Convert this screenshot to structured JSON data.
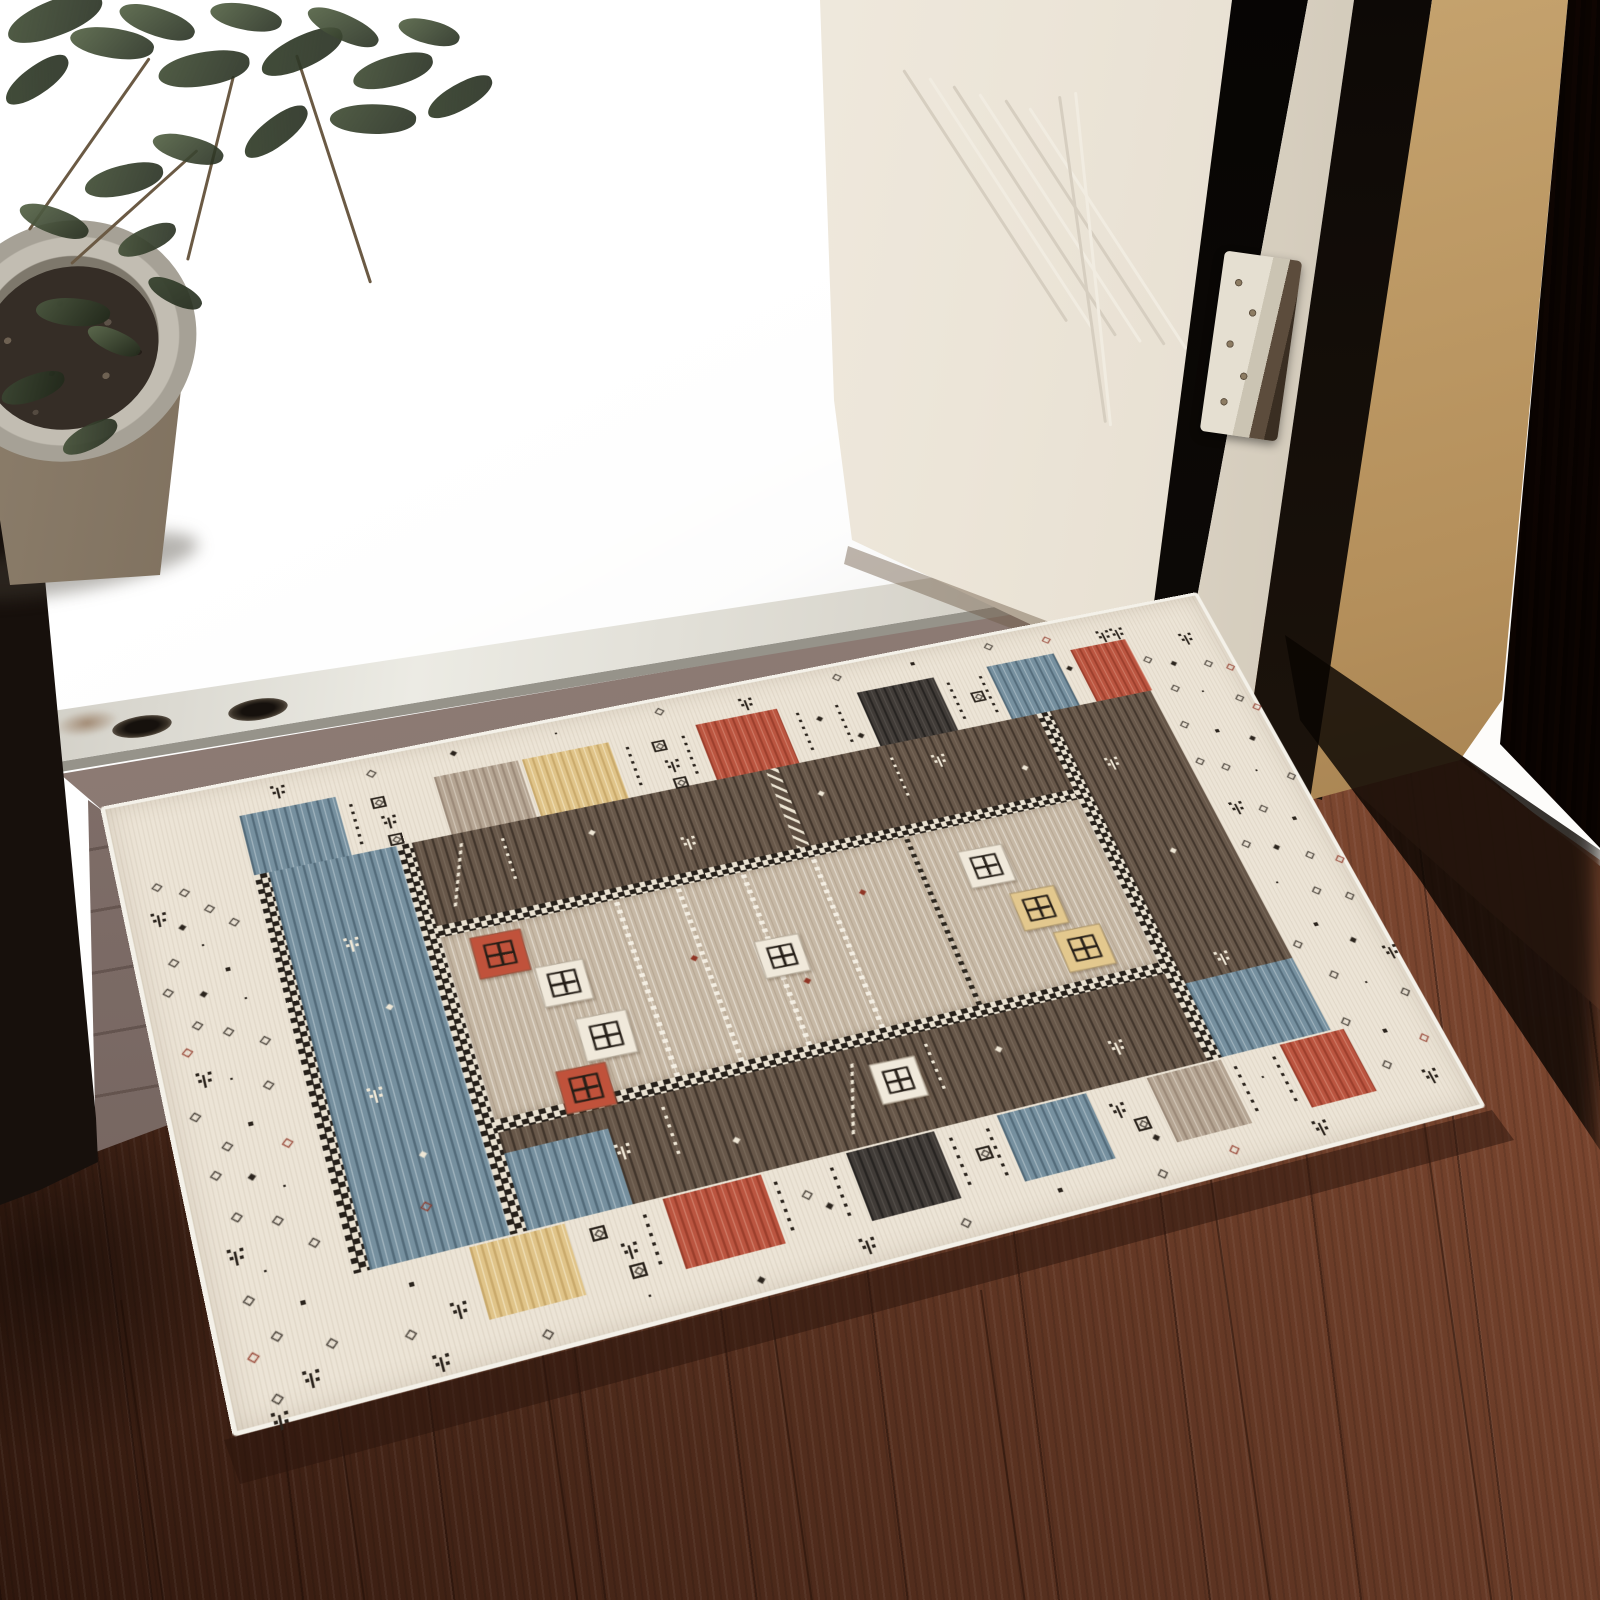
{
  "scene": {
    "kind": "product photograph",
    "subject": "bohemian gabbeh-style area rug lying at an open doorway on a dark wood floor",
    "elements": [
      "potted plant",
      "concrete step with bright daylight",
      "white door",
      "door hinge",
      "wood door frame",
      "metal threshold strip",
      "patterned area rug",
      "hardwood floor"
    ]
  },
  "palette": {
    "glare_white": "#ffffff",
    "concrete": "#c7c6c1",
    "metal_threshold": "#ecebe4",
    "wood_floor_light": "#9a5a40",
    "wood_floor_dark": "#2f170d",
    "door_white": "#f8f4ec",
    "door_frame_tan": "#b48f5b",
    "door_frame_dark": "#2e1b11",
    "rug_cream": "#ece4d6",
    "rug_blue": "#76909f",
    "rug_taupe": "#b5a593",
    "rug_yellow": "#e0c489",
    "rug_red": "#bb5540",
    "rug_dark_block": "#403b37",
    "rug_dark_band": "#675749",
    "rug_field_beige": "#c7b9a6",
    "motif_dark": "#2b241d",
    "motif_red": "#8f3525",
    "motif_white": "#efe7d6",
    "leaf_greens": [
      "#3c4733",
      "#4c5840",
      "#5f6d50"
    ]
  },
  "rug": {
    "blocks_top": [
      {
        "x": 118,
        "w": 88,
        "c": "blue"
      },
      {
        "x": 298,
        "w": 80,
        "c": "taupe"
      },
      {
        "x": 382,
        "w": 84,
        "c": "yellow"
      },
      {
        "x": 552,
        "w": 82,
        "c": "red"
      },
      {
        "x": 716,
        "w": 80,
        "c": "dark"
      },
      {
        "x": 852,
        "w": 72,
        "c": "blue"
      },
      {
        "x": 942,
        "w": 60,
        "c": "red"
      }
    ],
    "blocks_bottom": [
      {
        "x": 212,
        "w": 80,
        "c": "yellow"
      },
      {
        "x": 376,
        "w": 86,
        "c": "red"
      },
      {
        "x": 538,
        "w": 80,
        "c": "dark"
      },
      {
        "x": 676,
        "w": 84,
        "c": "blue"
      },
      {
        "x": 818,
        "w": 72,
        "c": "taupe"
      },
      {
        "x": 948,
        "w": 64,
        "c": "red"
      }
    ],
    "squares": [
      {
        "x": 285,
        "y": 230,
        "s": 46,
        "bg": "red"
      },
      {
        "x": 332,
        "y": 276,
        "s": 44,
        "bg": "white"
      },
      {
        "x": 352,
        "y": 338,
        "s": 46,
        "bg": "white"
      },
      {
        "x": 322,
        "y": 386,
        "s": 44,
        "bg": "red"
      },
      {
        "x": 528,
        "y": 300,
        "s": 42,
        "bg": "white"
      },
      {
        "x": 742,
        "y": 252,
        "s": 44,
        "bg": "white"
      },
      {
        "x": 772,
        "y": 310,
        "s": 44,
        "bg": "yellow"
      },
      {
        "x": 795,
        "y": 362,
        "s": 46,
        "bg": "yellow"
      },
      {
        "x": 585,
        "y": 452,
        "s": 42,
        "bg": "white"
      }
    ],
    "chains": [
      {
        "x": 420,
        "c": "w"
      },
      {
        "x": 478,
        "c": "w"
      },
      {
        "x": 540,
        "c": "w"
      },
      {
        "x": 608,
        "c": "w"
      },
      {
        "x": 700,
        "c": "b"
      }
    ],
    "motifs": [
      [
        "d",
        30,
        100
      ],
      [
        "d",
        52,
        112
      ],
      [
        "t",
        22,
        130
      ],
      [
        "d",
        70,
        135
      ],
      [
        "dd",
        45,
        150
      ],
      [
        "d",
        88,
        155
      ],
      [
        "k",
        60,
        175
      ],
      [
        "d",
        30,
        185
      ],
      [
        "K",
        75,
        205
      ],
      [
        "d",
        20,
        215
      ],
      [
        "dd",
        50,
        225
      ],
      [
        "k",
        85,
        240
      ],
      [
        "d",
        38,
        255
      ],
      [
        "d",
        62,
        268
      ],
      [
        "d",
        25,
        280,
        "r"
      ],
      [
        "d",
        90,
        285
      ],
      [
        "t",
        30,
        305
      ],
      [
        "k",
        58,
        318
      ],
      [
        "d",
        84,
        330
      ],
      [
        "d",
        20,
        345
      ],
      [
        "K",
        64,
        365
      ],
      [
        "d",
        40,
        380
      ],
      [
        "d",
        88,
        390,
        "r"
      ],
      [
        "d",
        26,
        405
      ],
      [
        "dd",
        55,
        415
      ],
      [
        "k",
        80,
        432
      ],
      [
        "d",
        35,
        448
      ],
      [
        "d",
        66,
        460
      ],
      [
        "t",
        24,
        478
      ],
      [
        "d",
        90,
        488
      ],
      [
        "k",
        50,
        505
      ],
      [
        "d",
        30,
        525
      ],
      [
        "K",
        72,
        540
      ],
      [
        "d",
        45,
        562
      ],
      [
        "d",
        24,
        575,
        "r"
      ],
      [
        "d",
        85,
        580
      ],
      [
        "t",
        60,
        600
      ],
      [
        "d",
        35,
        615
      ],
      [
        "t",
        1056,
        48
      ],
      [
        "d",
        1010,
        70
      ],
      [
        "dd",
        1035,
        82
      ],
      [
        "d",
        1068,
        90
      ],
      [
        "d",
        1088,
        100,
        "r"
      ],
      [
        "d",
        1022,
        112
      ],
      [
        "k",
        1050,
        125
      ],
      [
        "d",
        1080,
        140
      ],
      [
        "d",
        1092,
        155,
        "r"
      ],
      [
        "d",
        1012,
        158
      ],
      [
        "K",
        1042,
        175
      ],
      [
        "dd",
        1072,
        192
      ],
      [
        "d",
        1008,
        205
      ],
      [
        "d",
        1030,
        218
      ],
      [
        "k",
        1060,
        232
      ],
      [
        "d",
        1088,
        245
      ],
      [
        "t",
        1016,
        262
      ],
      [
        "d",
        1044,
        275
      ],
      [
        "K",
        1070,
        295
      ],
      [
        "d",
        1010,
        310
      ],
      [
        "dd",
        1038,
        322
      ],
      [
        "d",
        1064,
        338
      ],
      [
        "d",
        1090,
        350,
        "r"
      ],
      [
        "k",
        1022,
        362
      ],
      [
        "d",
        1052,
        378
      ],
      [
        "d",
        1080,
        392
      ],
      [
        "K",
        1036,
        415
      ],
      [
        "d",
        1008,
        430
      ],
      [
        "dd",
        1062,
        440
      ],
      [
        "t",
        1086,
        455
      ],
      [
        "d",
        1026,
        470
      ],
      [
        "k",
        1054,
        488
      ],
      [
        "d",
        1082,
        505
      ],
      [
        "d",
        1014,
        520
      ],
      [
        "K",
        1046,
        540
      ],
      [
        "d",
        1076,
        555,
        "r"
      ],
      [
        "d",
        1030,
        572
      ],
      [
        "t",
        1060,
        588
      ],
      [
        "t",
        150,
        14
      ],
      [
        "d",
        240,
        20
      ],
      [
        "dd",
        320,
        16
      ],
      [
        "k",
        420,
        18
      ],
      [
        "d",
        520,
        14
      ],
      [
        "t",
        600,
        20
      ],
      [
        "d",
        700,
        15
      ],
      [
        "K",
        780,
        18
      ],
      [
        "d",
        860,
        14
      ],
      [
        "d",
        920,
        20,
        "r"
      ],
      [
        "t",
        975,
        24
      ],
      [
        "t",
        990,
        24
      ],
      [
        "t",
        160,
        615
      ],
      [
        "d",
        250,
        620
      ],
      [
        "k",
        340,
        612
      ],
      [
        "dd",
        430,
        622
      ],
      [
        "t",
        520,
        610
      ],
      [
        "d",
        610,
        618
      ],
      [
        "K",
        700,
        612
      ],
      [
        "d",
        790,
        620
      ],
      [
        "d",
        860,
        615,
        "r"
      ],
      [
        "t",
        940,
        610
      ],
      [
        "t",
        30,
        628
      ],
      [
        "box",
        236,
        52
      ],
      [
        "t",
        240,
        74
      ],
      [
        "box",
        242,
        98
      ],
      [
        "dv",
        216,
        50
      ],
      [
        "dv",
        480,
        48
      ],
      [
        "box",
        505,
        52
      ],
      [
        "t",
        510,
        76
      ],
      [
        "box",
        512,
        100
      ],
      [
        "dv",
        535,
        48
      ],
      [
        "dv",
        650,
        48
      ],
      [
        "dd",
        668,
        62
      ],
      [
        "dv",
        690,
        48
      ],
      [
        "dd",
        700,
        92
      ],
      [
        "dv",
        806,
        48
      ],
      [
        "box",
        824,
        70
      ],
      [
        "dv",
        840,
        48
      ],
      [
        "dd",
        930,
        62
      ],
      [
        "box",
        310,
        540
      ],
      [
        "t",
        330,
        560
      ],
      [
        "box",
        332,
        582
      ],
      [
        "dv",
        356,
        536
      ],
      [
        "dv",
        470,
        536
      ],
      [
        "d",
        490,
        556
      ],
      [
        "dd",
        506,
        572
      ],
      [
        "dv",
        520,
        536
      ],
      [
        "dv",
        628,
        536
      ],
      [
        "box",
        646,
        556
      ],
      [
        "dv",
        662,
        536
      ],
      [
        "t",
        774,
        545
      ],
      [
        "box",
        790,
        566
      ],
      [
        "dd",
        800,
        586
      ],
      [
        "dv",
        898,
        536
      ],
      [
        "k",
        918,
        556
      ],
      [
        "dv",
        936,
        536
      ],
      [
        "K",
        158,
        548
      ],
      [
        "t",
        184,
        574
      ],
      [
        "d",
        146,
        590
      ],
      [
        "zz",
        292,
        122,
        "w"
      ],
      [
        "dd",
        420,
        140,
        "w"
      ],
      [
        "t",
        498,
        168,
        "w"
      ],
      [
        "dd",
        640,
        150,
        "w"
      ],
      [
        "t",
        758,
        134,
        "w"
      ],
      [
        "dd",
        840,
        170,
        "w"
      ],
      [
        "dv",
        340,
        124,
        "w"
      ],
      [
        "dv",
        720,
        124,
        "w"
      ],
      [
        "t",
        350,
        468,
        "w"
      ],
      [
        "dd",
        450,
        490,
        "w"
      ],
      [
        "zz",
        560,
        444,
        "w"
      ],
      [
        "dd",
        700,
        464,
        "w"
      ],
      [
        "t",
        798,
        484,
        "w"
      ],
      [
        "dv",
        400,
        440,
        "w"
      ],
      [
        "dv",
        640,
        440,
        "w"
      ],
      [
        "t",
        178,
        200,
        "w"
      ],
      [
        "dd",
        200,
        280,
        "w"
      ],
      [
        "t",
        164,
        358,
        "w"
      ],
      [
        "dd",
        194,
        432,
        "w"
      ],
      [
        "d",
        184,
        480,
        "r"
      ],
      [
        "dd",
        470,
        300,
        "r"
      ],
      [
        "dd",
        560,
        350,
        "r"
      ],
      [
        "dd",
        640,
        270,
        "r"
      ],
      [
        "t",
        920,
        180,
        "w"
      ],
      [
        "dd",
        940,
        300,
        "w"
      ],
      [
        "t",
        930,
        420,
        "w"
      ]
    ]
  },
  "door": {
    "ridges": [
      {
        "x": 902,
        "y": 70,
        "h": 300,
        "r": -33
      },
      {
        "x": 928,
        "y": 78,
        "h": 300,
        "r": -33
      },
      {
        "x": 952,
        "y": 86,
        "h": 298,
        "r": -33
      },
      {
        "x": 978,
        "y": 94,
        "h": 296,
        "r": -33
      },
      {
        "x": 1004,
        "y": 100,
        "h": 292,
        "r": -33
      },
      {
        "x": 1028,
        "y": 108,
        "h": 288,
        "r": -33
      },
      {
        "x": 1058,
        "y": 96,
        "h": 330,
        "r": -8
      },
      {
        "x": 1074,
        "y": 92,
        "h": 336,
        "r": -6
      }
    ]
  },
  "plant": {
    "leaves": [
      [
        5,
        0,
        100,
        36,
        -18,
        1
      ],
      [
        70,
        28,
        84,
        30,
        12,
        2
      ],
      [
        0,
        66,
        74,
        28,
        -32,
        0
      ],
      [
        118,
        8,
        78,
        28,
        22,
        2
      ],
      [
        158,
        52,
        92,
        34,
        -6,
        1
      ],
      [
        210,
        4,
        72,
        26,
        14,
        2
      ],
      [
        258,
        36,
        88,
        32,
        -22,
        0
      ],
      [
        305,
        14,
        76,
        26,
        28,
        2
      ],
      [
        352,
        56,
        82,
        30,
        -12,
        1
      ],
      [
        398,
        20,
        62,
        24,
        18,
        2
      ],
      [
        424,
        84,
        72,
        26,
        -26,
        0
      ],
      [
        330,
        104,
        86,
        30,
        4,
        1
      ],
      [
        238,
        118,
        76,
        28,
        -34,
        0
      ],
      [
        152,
        136,
        72,
        26,
        18,
        2
      ],
      [
        84,
        165,
        80,
        30,
        -10,
        1
      ],
      [
        18,
        208,
        72,
        26,
        24,
        2
      ],
      [
        116,
        228,
        62,
        24,
        -20,
        1
      ],
      [
        146,
        282,
        58,
        22,
        30,
        0
      ],
      [
        36,
        298,
        74,
        28,
        8,
        1
      ],
      [
        0,
        375,
        66,
        26,
        -16,
        0
      ],
      [
        86,
        330,
        56,
        22,
        28,
        2
      ],
      [
        60,
        425,
        60,
        24,
        -24,
        1
      ]
    ],
    "stems": [
      [
        148,
        58,
        210,
        35
      ],
      [
        232,
        76,
        190,
        14
      ],
      [
        295,
        55,
        240,
        -18
      ],
      [
        196,
        150,
        170,
        48
      ]
    ]
  },
  "floor": {
    "seams": [
      {
        "x": 300,
        "y": 1150,
        "h": 520
      },
      {
        "x": 520,
        "y": 1200,
        "h": 460
      },
      {
        "x": 760,
        "y": 1240,
        "h": 420
      },
      {
        "x": 980,
        "y": 1290,
        "h": 360
      },
      {
        "x": 1210,
        "y": 1180,
        "h": 460
      },
      {
        "x": 120,
        "y": 1300,
        "h": 340
      },
      {
        "x": 1420,
        "y": 1100,
        "h": 520
      }
    ]
  }
}
